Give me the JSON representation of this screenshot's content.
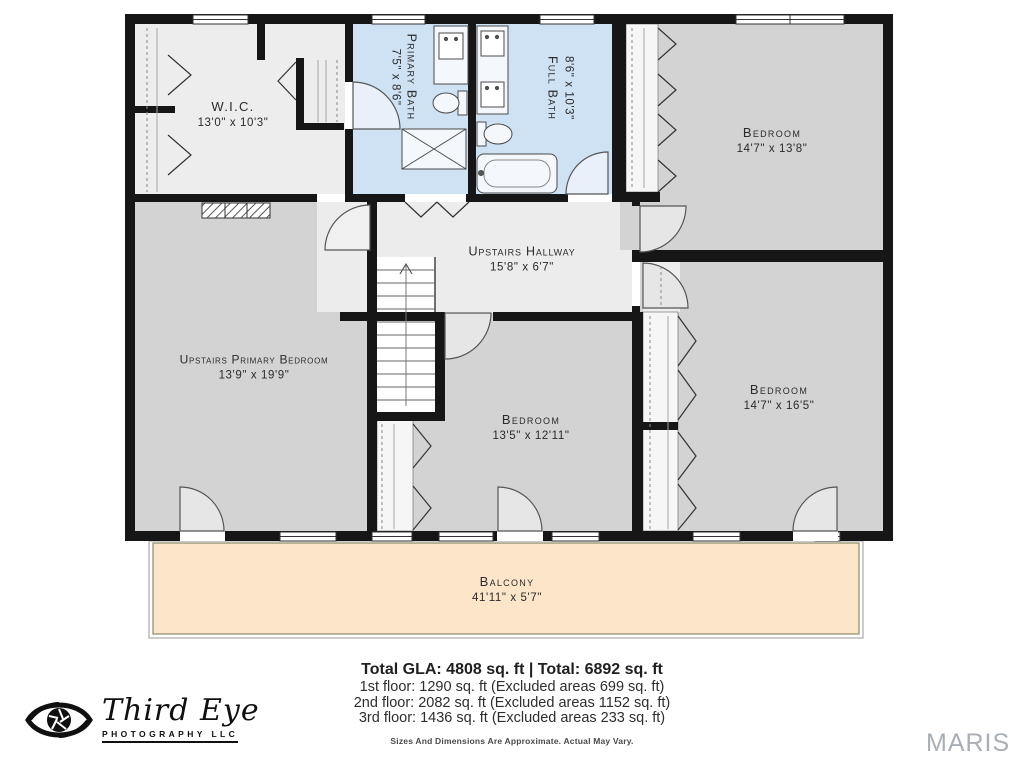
{
  "rooms": {
    "wic": {
      "name": "W.I.C.",
      "dims": "13'0\" x 10'3\""
    },
    "primary_bath": {
      "name": "Primary Bath",
      "dims": "7'5\" x 8'6\""
    },
    "full_bath": {
      "name": "Full Bath",
      "dims": "8'6\" x 10'3\""
    },
    "bedroom_top_right": {
      "name": "Bedroom",
      "dims": "14'7\" x 13'8\""
    },
    "hallway": {
      "name": "Upstairs Hallway",
      "dims": "15'8\" x 6'7\""
    },
    "primary_bedroom": {
      "name": "Upstairs Primary Bedroom",
      "dims": "13'9\" x 19'9\""
    },
    "bedroom_middle": {
      "name": "Bedroom",
      "dims": "13'5\" x 12'11\""
    },
    "bedroom_bottom_right": {
      "name": "Bedroom",
      "dims": "14'7\" x 16'5\""
    },
    "balcony": {
      "name": "Balcony",
      "dims": "41'11\" x 5'7\""
    }
  },
  "footer": {
    "totals": "Total GLA: 4808 sq. ft | Total: 6892 sq. ft",
    "floor1": "1st floor: 1290 sq. ft (Excluded areas 699 sq. ft)",
    "floor2": "2nd floor: 2082 sq. ft (Excluded areas 1152 sq. ft)",
    "floor3": "3rd floor: 1436 sq. ft (Excluded areas 233 sq. ft)",
    "disclaimer": "Sizes And Dimensions Are Approximate. Actual May Vary."
  },
  "logo": {
    "name": "Third Eye",
    "subtitle": "PHOTOGRAPHY LLC"
  },
  "watermark": {
    "text": "MARIS"
  },
  "colors": {
    "wall": "#161616",
    "bedroom_fill": "#d3d3d3",
    "hall_fill": "#ececec",
    "bath_fill": "#cfe2f4",
    "closet_fill": "#f6f6f6",
    "balcony_fill": "#fce5c9",
    "watermark_gray": "#a9afb6"
  }
}
